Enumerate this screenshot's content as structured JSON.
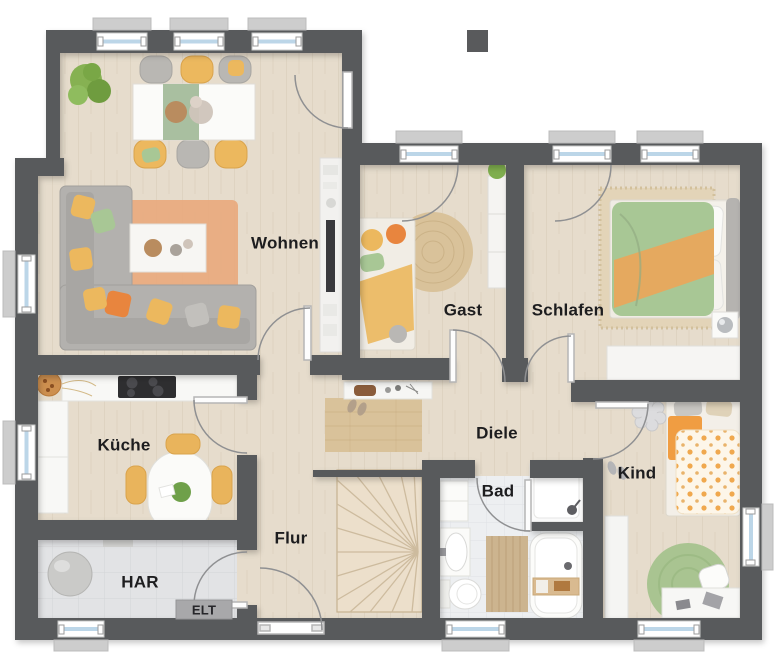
{
  "plan": {
    "rooms": {
      "wohnen": {
        "label": "Wohnen"
      },
      "gast": {
        "label": "Gast"
      },
      "schlafen": {
        "label": "Schlafen"
      },
      "kueche": {
        "label": "Küche"
      },
      "diele": {
        "label": "Diele"
      },
      "kind": {
        "label": "Kind"
      },
      "bad": {
        "label": "Bad"
      },
      "flur": {
        "label": "Flur"
      },
      "har": {
        "label": "HAR"
      },
      "elt": {
        "label": "ELT"
      }
    },
    "colors": {
      "wall": "#595a5c",
      "wood_floor": "#e6dccc",
      "tile_floor_har": "#e2e3e5",
      "tile_floor_bad": "#edeff1",
      "stair_floor": "#ecdfcb",
      "accent_orange": "#e8943f",
      "accent_yellow": "#ecb85e",
      "accent_green": "#a8c795",
      "rug_terracotta": "#e9a97c",
      "rug_jute": "#d9c29a",
      "rug_kind": "#a9c491",
      "window_glass": "#bcd6e8",
      "furniture_white": "#f7f6f4",
      "label_text": "#1d1d1f"
    }
  }
}
